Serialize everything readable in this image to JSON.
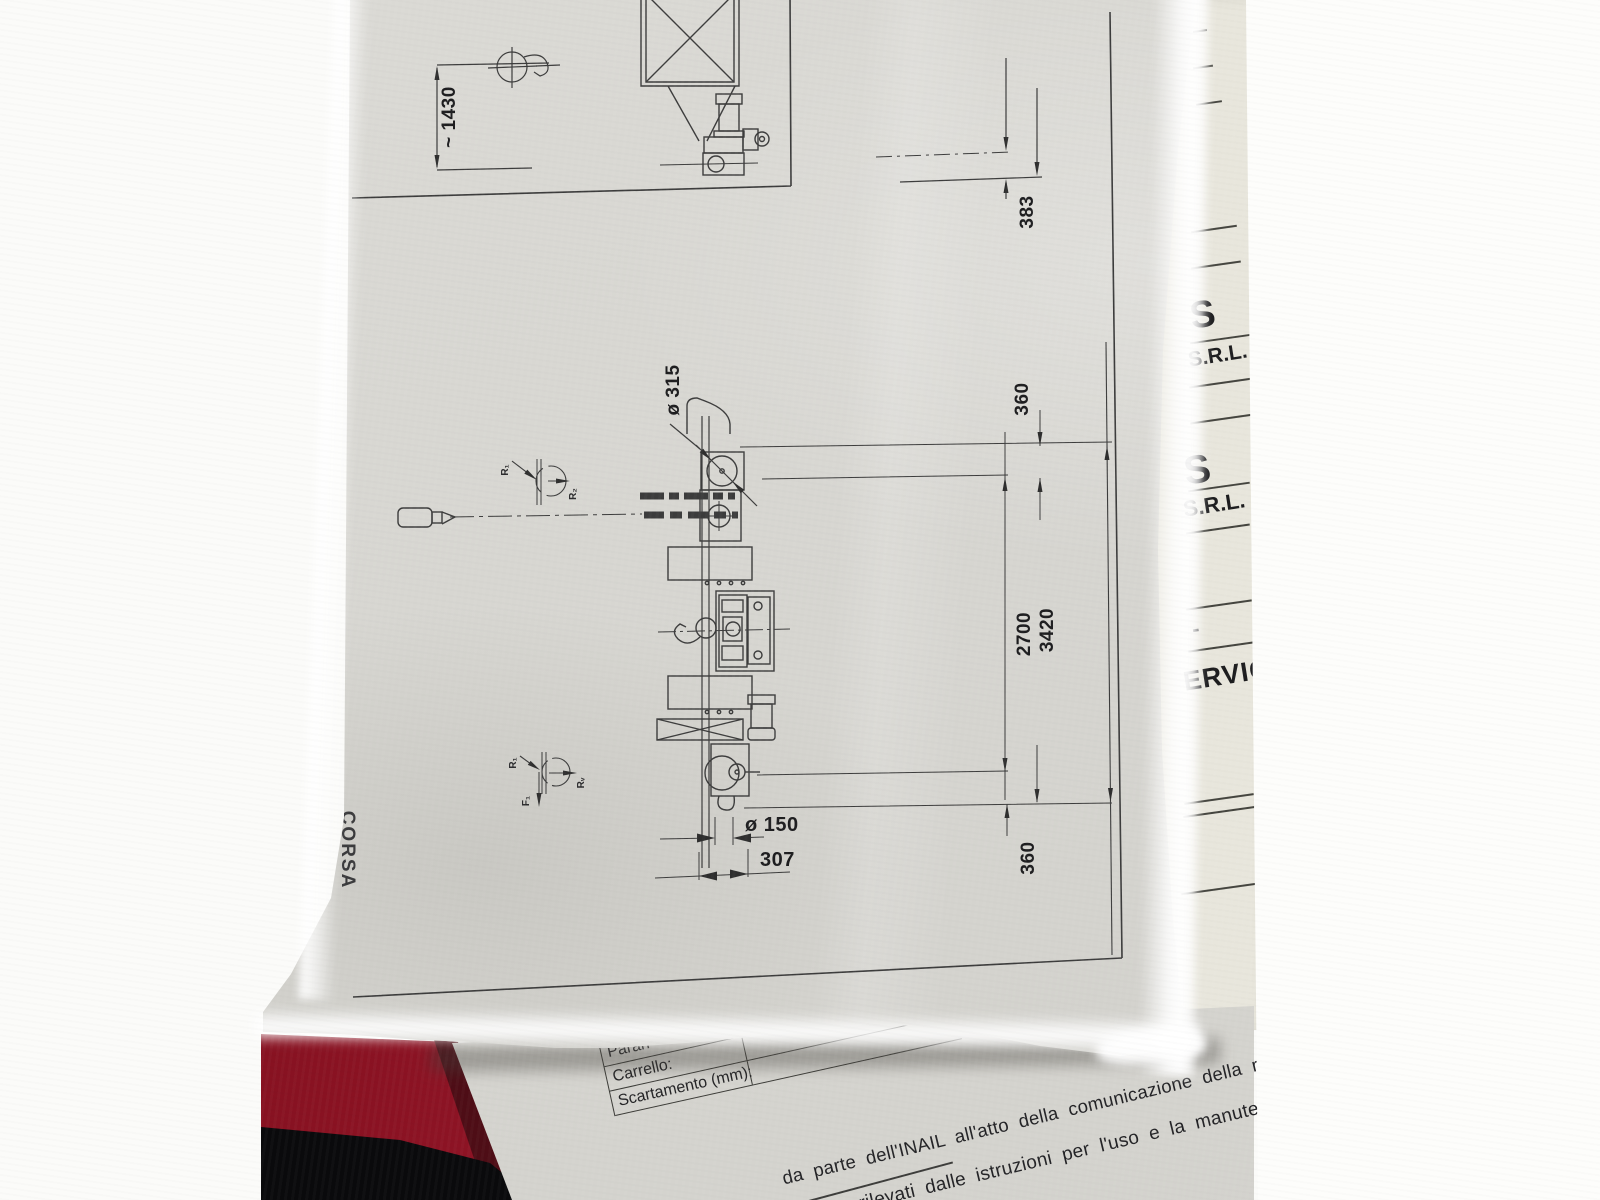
{
  "drawing": {
    "dims": {
      "height_approx": "~ 1430",
      "d383": "383",
      "dia315": "ø 315",
      "d360_top": "360",
      "d2700": "2700",
      "d3420": "3420",
      "d360_bottom": "360",
      "dia150": "ø 150",
      "d307": "307"
    },
    "force_symbols": {
      "top": {
        "r1": "R₁",
        "r2": "R₂"
      },
      "bottom": {
        "r1": "R₁",
        "rv": "Rᵥ",
        "f": "F₁"
      }
    },
    "margin_note": "CORSA"
  },
  "letterhead": {
    "company_suffix_1": "S",
    "srl_1": "S.R.L.",
    "company_suffix_2": "S",
    "srl_2": "S.R.L.",
    "dash": "-",
    "service_fragment": "ERVIC"
  },
  "spec_sheet": {
    "rows": [
      {
        "label": "Paran"
      },
      {
        "label": "Carrello:"
      },
      {
        "label": "Scartamento (mm):"
      }
    ],
    "note_line_1": "da parte dell'INAIL all'atto della comunicazione della r",
    "note_line_2": "o rilevati dalle istruzioni per l'uso e la manute"
  }
}
